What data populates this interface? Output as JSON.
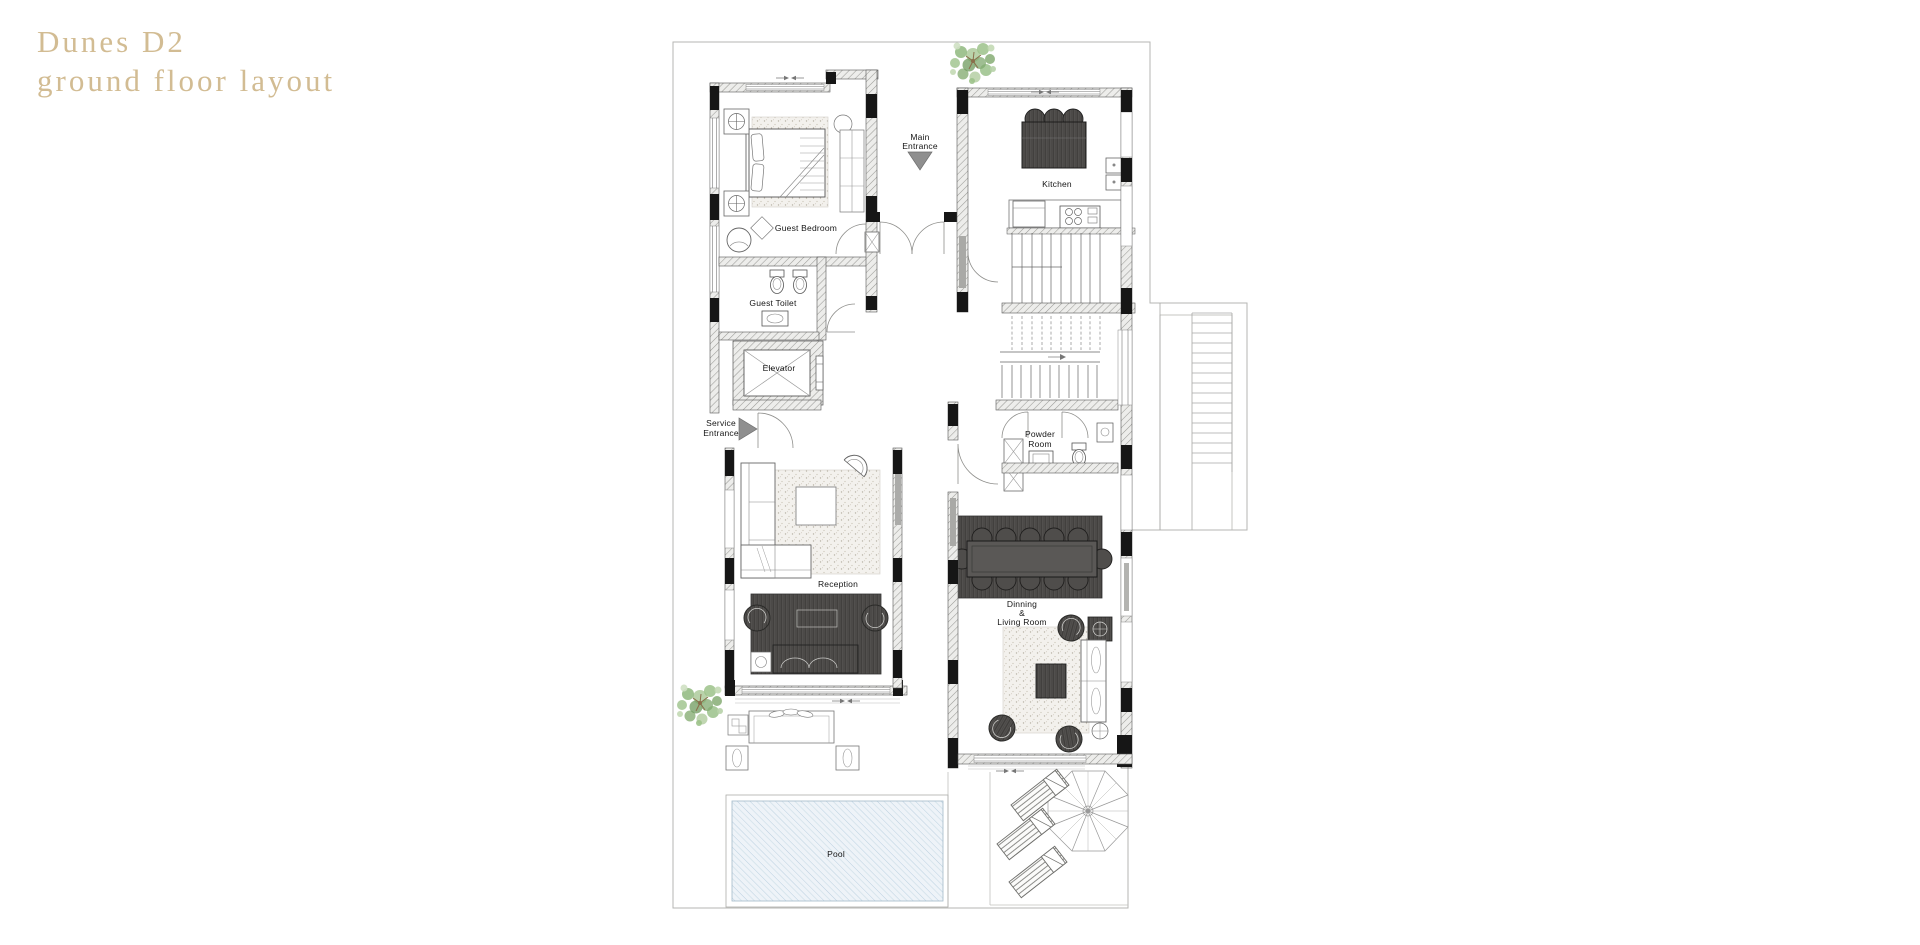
{
  "title": {
    "line1": "Dunes D2",
    "line2": "ground floor layout"
  },
  "plan": {
    "labels": {
      "main_entrance": [
        "Main",
        "Entrance"
      ],
      "service_entrance": [
        "Service",
        "Entrance"
      ],
      "kitchen": "Kitchen",
      "guest_bedroom": "Guest Bedroom",
      "guest_toilet": "Guest Toilet",
      "elevator": "Elevator",
      "powder_room": [
        "Powder",
        "Room"
      ],
      "reception": "Reception",
      "dining_living": [
        "Dinning",
        "&",
        "Living Room"
      ],
      "pool": "Pool"
    },
    "colors": {
      "title_text": "#d2bc93",
      "background": "#ffffff",
      "site_boundary": "#b6b6b3",
      "wall_fill": "#ededeb",
      "wall_black": "#161616",
      "drawing_line": "#4c4c4a",
      "door_arc": "#8f8f8c",
      "entrance_arrow": "#8f8f8f",
      "dark_furniture": "#555351",
      "light_rug": "#f3f1ed",
      "pool_water": "#eef3f8",
      "pool_hatch": "#bad0e0",
      "tree_foliage": "#8fb97e",
      "tree_trunk": "#8a6e4b"
    }
  }
}
